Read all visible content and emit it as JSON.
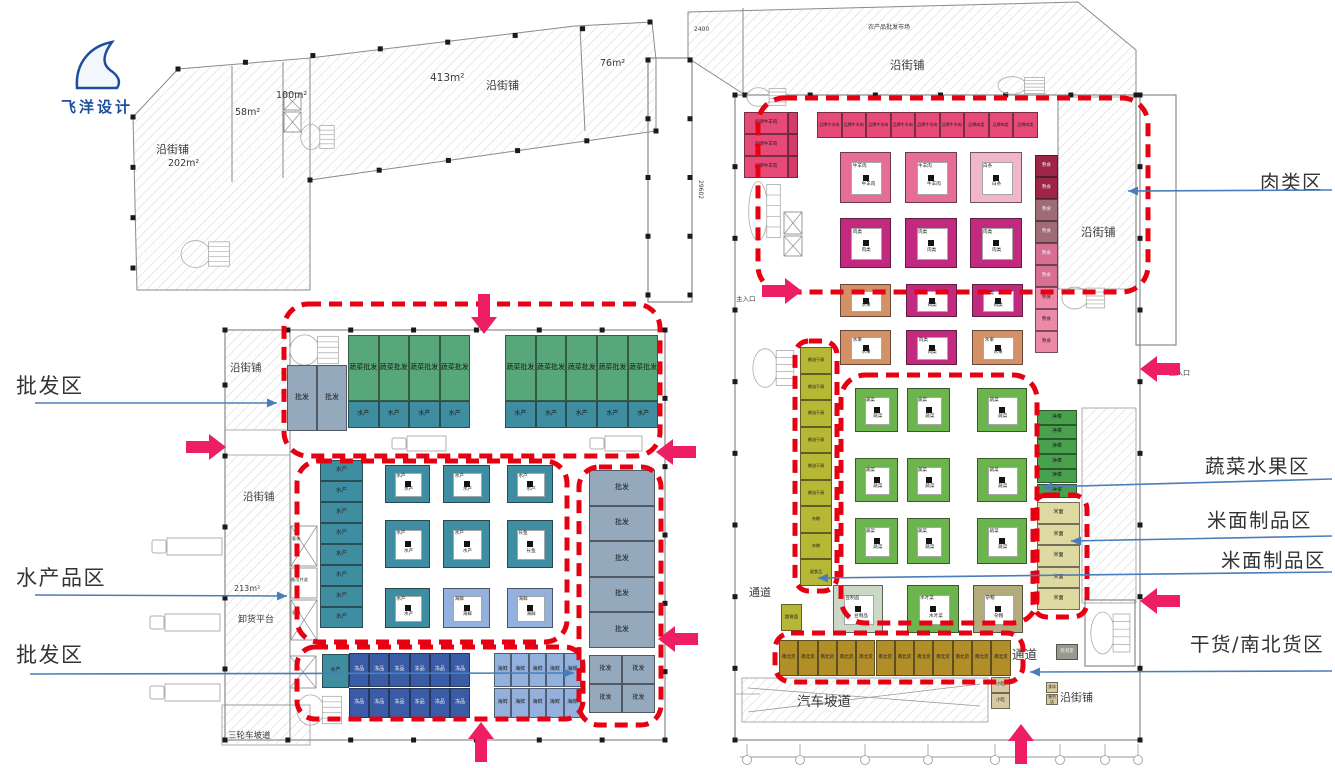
{
  "logo": {
    "text": "飞洋设计"
  },
  "annotations": {
    "left": [
      {
        "label": "批发区"
      },
      {
        "label": "水产品区"
      },
      {
        "label": "批发区"
      }
    ],
    "right": [
      {
        "label": "肉类区"
      },
      {
        "label": "蔬菜水果区"
      },
      {
        "label": "米面制品区"
      },
      {
        "label": "米面制品区"
      },
      {
        "label": "干货/南北货区"
      }
    ]
  },
  "wing": {
    "shop": "沿街铺",
    "a202": "202m²",
    "a58": "58m²",
    "a100": "100m²",
    "a413": "413m²",
    "a76": "76m²"
  },
  "left": {
    "shop": "沿街铺",
    "a213": "213m²",
    "unload": "卸货平台",
    "ramp3": "三轮车坡道",
    "keti": "客梯",
    "beiyong": "备用井道"
  },
  "right": {
    "shop": "沿街铺",
    "market_title": "农产品批发市场",
    "d2400": "2400",
    "d29602": "29602",
    "entrance": "主入口"
  },
  "stalls": {
    "pifa": "批发",
    "shucai_pifa": "蔬菜批发",
    "shuichan": "水产",
    "changyu": "长鱼",
    "haixian": "海鲜",
    "dongpin": "冻品",
    "pin_niu": "品牌牛羊肉",
    "pin_rou": "品牌肉类",
    "niuyang": "牛羊肉",
    "baitiao": "白条",
    "roulei": "肉类",
    "shushi": "熟食",
    "shuiguo": "水果",
    "liangyou": "粮油干调",
    "zaliang": "杂粮",
    "fushipin": "副食品",
    "shucai": "蔬菜",
    "jingcai": "净菜",
    "mimian": "米面",
    "douzhipin": "豆制品",
    "shuiyecai": "水叶菜",
    "nanbei": "南北货"
  },
  "rooms": {
    "passage": "通道",
    "jiance": "检测室",
    "xiaochi": "小吃",
    "maibing": "卖冰",
    "bianlidian": "便利店",
    "ramp": "汽车坡道"
  },
  "colors": {
    "dash": "#e60012",
    "arrow": "#ed1e63",
    "leader": "#4a7ebb",
    "gray": "#94a9bc",
    "green": "#57a77a",
    "teal": "#3f8da0",
    "navy": "#3a5ca6",
    "ltblue": "#93b1dc",
    "meatpink": "#e84a78",
    "meatpink2": "#d63a68",
    "meatring": "#e56d96",
    "magenta": "#c22a80",
    "ltpink": "#f1b6cb",
    "darkred": "#9e2546",
    "mauve": "#a06b74",
    "pink2": "#d66f92",
    "pink3": "#ec88a8",
    "orange": "#d49166",
    "yellow": "#b5b735",
    "green2": "#48a24c",
    "greenI": "#6cb44e",
    "tan": "#ded9a1",
    "olive": "#b18e28",
    "pale": "#cbd8c6",
    "oliveI": "#b2ac7d",
    "grayroom": "#99998f",
    "tan2": "#d6c8a0"
  }
}
